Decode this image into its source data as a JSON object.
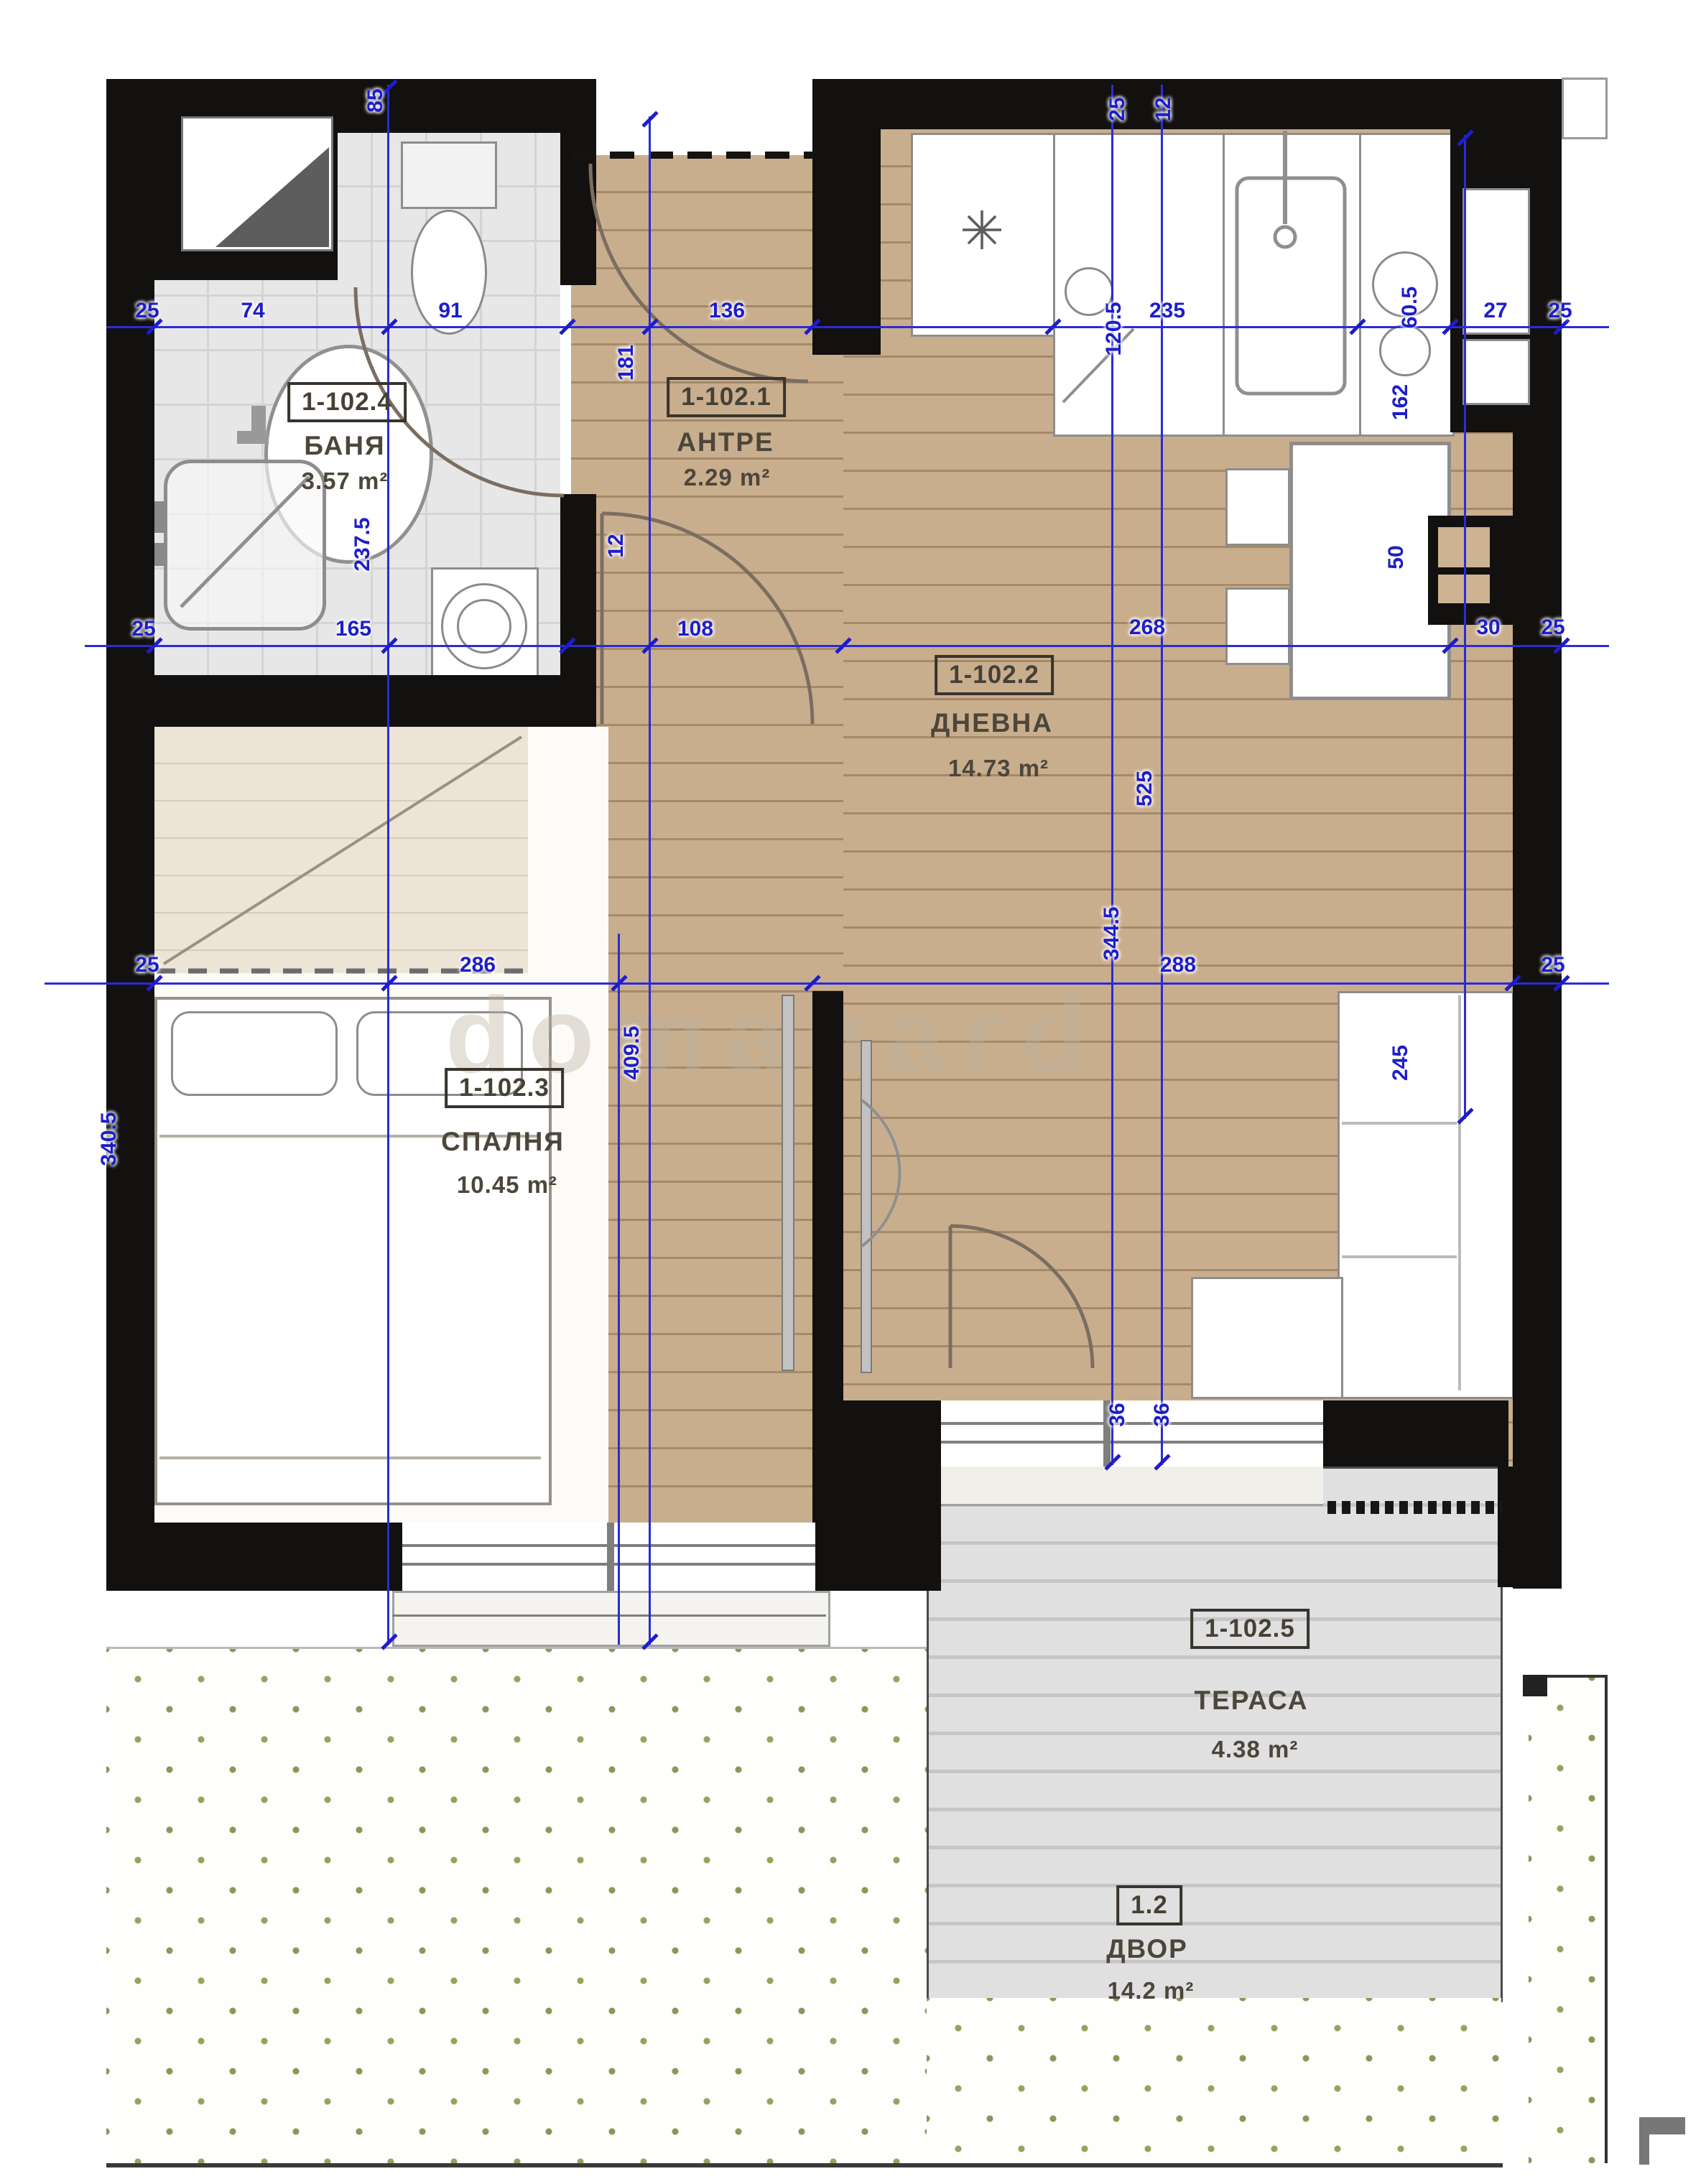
{
  "plan": {
    "watermark": "domahard",
    "rooms": {
      "bath": {
        "id": "1-102.4",
        "name": "БАНЯ",
        "area": "3.57 m²"
      },
      "antre": {
        "id": "1-102.1",
        "name": "АНТРЕ",
        "area": "2.29 m²"
      },
      "living": {
        "id": "1-102.2",
        "name": "ДНЕВНА",
        "area": "14.73 m²"
      },
      "bedroom": {
        "id": "1-102.3",
        "name": "СПАЛНЯ",
        "area": "10.45 m²"
      },
      "terrace": {
        "id": "1-102.5",
        "name": "ТЕРАСА",
        "area": "4.38 m²"
      },
      "yard": {
        "id": "1.2",
        "name": "ДВОР",
        "area": "14.2 m²"
      }
    },
    "dims": {
      "row1": [
        "25",
        "74",
        "91",
        "136",
        "235",
        "60.5",
        "27",
        "25"
      ],
      "row2": [
        "25",
        "165",
        "108",
        "268",
        "30",
        "25"
      ],
      "row3": [
        "25",
        "286",
        "288",
        "25"
      ],
      "v": {
        "bathTop": "85",
        "bath": "237.5",
        "antre": "181",
        "wall": "12",
        "kitchen": "120.5",
        "top1": "25",
        "top2": "12",
        "table": "162",
        "niche": "50",
        "living": "525",
        "living2": "344.5",
        "sofa": "245",
        "bedroom": "409.5",
        "bedWin": "340.5",
        "door1": "36",
        "door2": "36"
      }
    },
    "icons": {
      "fridge": "✳"
    },
    "colors": {
      "dim": "#1d1dcb",
      "wall": "#12110f",
      "wood": "#c9ae8e",
      "tile": "#e6e6e6",
      "terrace": "#dedede",
      "grass": "#9aa05f"
    }
  }
}
